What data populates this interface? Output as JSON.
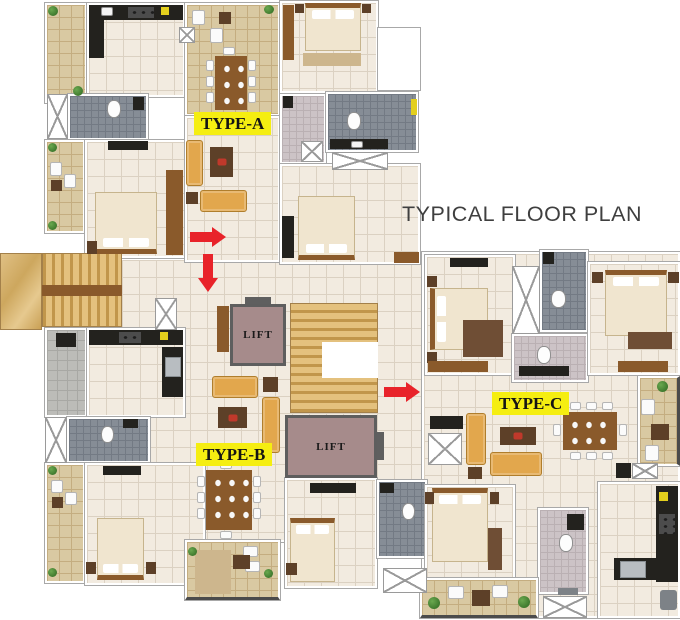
{
  "title": "TYPICAL FLOOR PLAN",
  "units": [
    {
      "id": "type-a",
      "label": "TYPE-A"
    },
    {
      "id": "type-b",
      "label": "TYPE-B"
    },
    {
      "id": "type-c",
      "label": "TYPE-C"
    }
  ],
  "lifts": [
    {
      "label": "LIFT"
    },
    {
      "label": "LIFT"
    }
  ],
  "arrows": [
    {
      "id": "entry-arrow-type-a",
      "direction": "right"
    },
    {
      "id": "entry-arrow-type-b",
      "direction": "down"
    },
    {
      "id": "entry-arrow-type-c",
      "direction": "right"
    }
  ],
  "colors": {
    "floor": "#f2ebe0",
    "floor_line": "#dbd1c2",
    "balc": "#d9c9a2",
    "balc_line": "#c4ad80",
    "bath_dark": "#868d96",
    "bath_dark_line": "#737a84",
    "bath_light": "#ccc3c6",
    "bath_light_line": "#bab0b3",
    "util": "#bcbcb8",
    "util_line": "#a8a8a4",
    "counter": "#23221e",
    "stairs_light": "#e4c17e",
    "stairs_dark": "#c1964b",
    "lift": "#a68b8b",
    "lift_border": "#5e5e5e",
    "wood": "#8a5a2b",
    "wood_dark": "#5d4028",
    "sofa": "#e2a74d",
    "bed": "#f0e5cf",
    "label_bg": "#f5ee11",
    "arrow": "#e8232a",
    "title": "#3f3f3f",
    "wall_edge": "#a8a8a8",
    "plant": "#3f7a2e",
    "rug": "#6f4e35",
    "rug_tan": "#cdb68d"
  }
}
